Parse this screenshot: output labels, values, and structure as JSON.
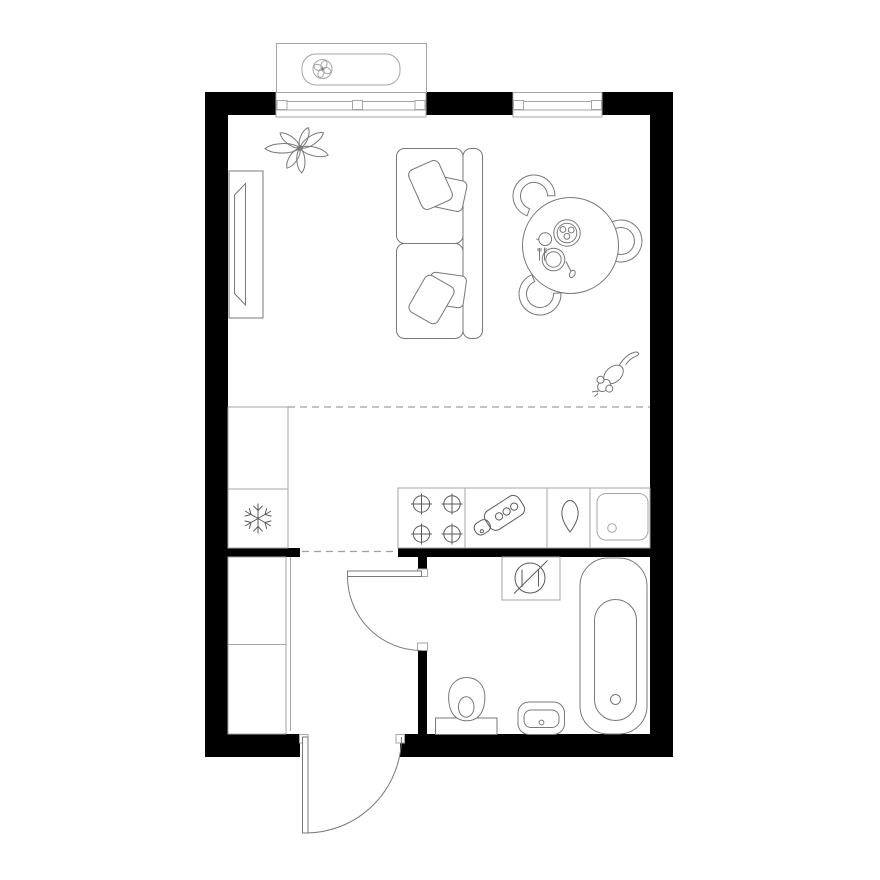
{
  "title": "Studio apartment floor plan",
  "colors": {
    "background": "#ffffff",
    "wall": "#000000",
    "furniture_line": "#787878",
    "cabinet_line": "#a6a6a6",
    "appliance_line": "#5a5a5a",
    "dashed_line": "#9e9e9e"
  },
  "counts": {
    "windows": 2,
    "doors": 2,
    "stove_burners": 4,
    "dining_chairs": 3,
    "sofa_pillows": 4,
    "plant_leaves": 7,
    "wardrobe_sections": 2
  },
  "objects": [
    {
      "id": "ac-unit",
      "label": "Air conditioner unit with fan"
    },
    {
      "id": "window-left",
      "label": "Window"
    },
    {
      "id": "window-right",
      "label": "Window"
    },
    {
      "id": "plant",
      "label": "Houseplant"
    },
    {
      "id": "tv-console",
      "label": "TV console"
    },
    {
      "id": "sofa",
      "label": "Two-seat sofa with pillows"
    },
    {
      "id": "dining-chairs",
      "label": "Dining chairs"
    },
    {
      "id": "dining-table",
      "label": "Round dining table with tableware"
    },
    {
      "id": "mouse",
      "label": "Mouse"
    },
    {
      "id": "kitchen-cabinets",
      "label": "Kitchen cabinets"
    },
    {
      "id": "fridge",
      "label": "Refrigerator (snowflake)"
    },
    {
      "id": "stove",
      "label": "Four-burner cooktop"
    },
    {
      "id": "cutting-board",
      "label": "Cutting board"
    },
    {
      "id": "water-drop",
      "label": "Water drop symbol"
    },
    {
      "id": "kitchen-sink",
      "label": "Kitchen sink"
    },
    {
      "id": "washing-machine",
      "label": "Washing machine place"
    },
    {
      "id": "bathtub",
      "label": "Bathtub"
    },
    {
      "id": "toilet",
      "label": "Toilet"
    },
    {
      "id": "washbasin",
      "label": "Washbasin"
    },
    {
      "id": "hallway-wardrobe",
      "label": "Hallway wardrobe"
    },
    {
      "id": "bathroom-door",
      "label": "Bathroom door"
    },
    {
      "id": "entrance-door",
      "label": "Entrance door"
    },
    {
      "id": "zone-boundaries",
      "label": "Zone boundary dashed lines"
    },
    {
      "id": "walls",
      "label": "Walls"
    }
  ]
}
